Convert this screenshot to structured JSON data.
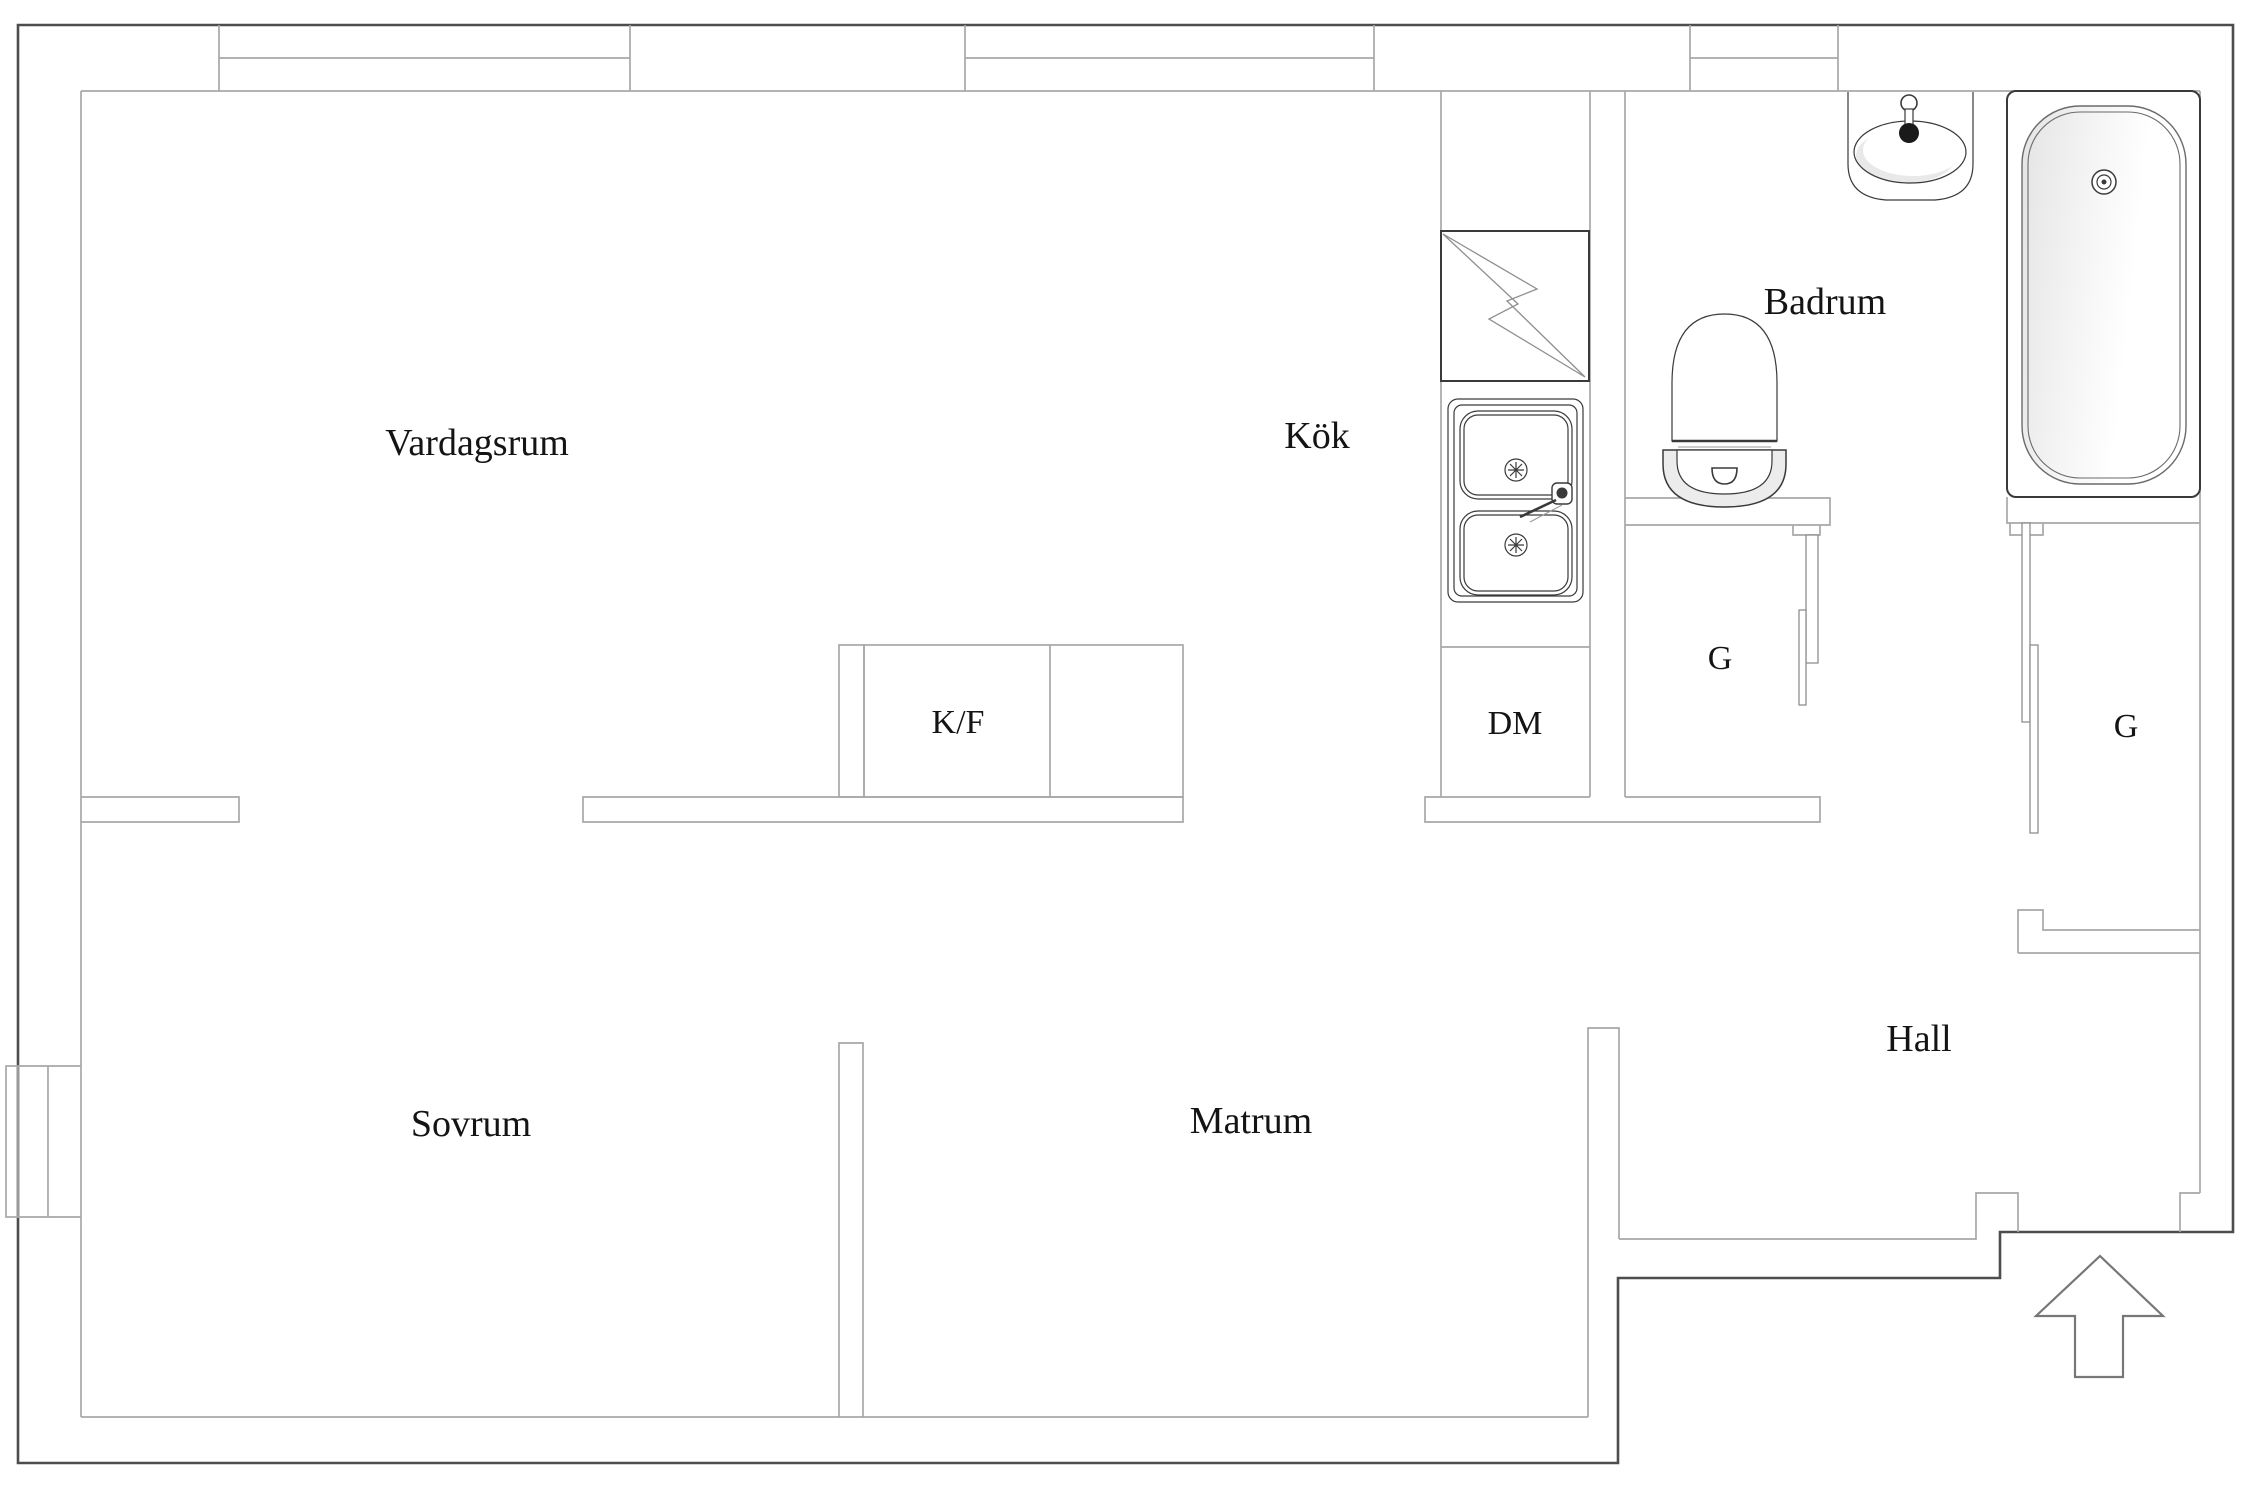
{
  "colors": {
    "background": "#ffffff",
    "wall_dark": "#4d4d4d",
    "wall_light": "#a8a8a8",
    "fixture_dark": "#3a3a3a",
    "fixture_light": "#8f8f8f",
    "text": "#141414",
    "tub_shade": "#e4e4e4",
    "arrow_outline": "#777777"
  },
  "rooms": [
    {
      "id": "vardagsrum",
      "label": "Vardagsrum"
    },
    {
      "id": "kok",
      "label": "Kök"
    },
    {
      "id": "badrum",
      "label": "Badrum"
    },
    {
      "id": "sovrum",
      "label": "Sovrum"
    },
    {
      "id": "matrum",
      "label": "Matrum"
    },
    {
      "id": "hall",
      "label": "Hall"
    }
  ],
  "fixtures": [
    {
      "id": "fridge_freezer",
      "label": "K/F"
    },
    {
      "id": "dishwasher",
      "label": "DM"
    },
    {
      "id": "wardrobe_left",
      "label": "G"
    },
    {
      "id": "wardrobe_right",
      "label": "G"
    }
  ],
  "symbols": {
    "entrance": "arrow-up",
    "stove": "lightning-bolt"
  }
}
